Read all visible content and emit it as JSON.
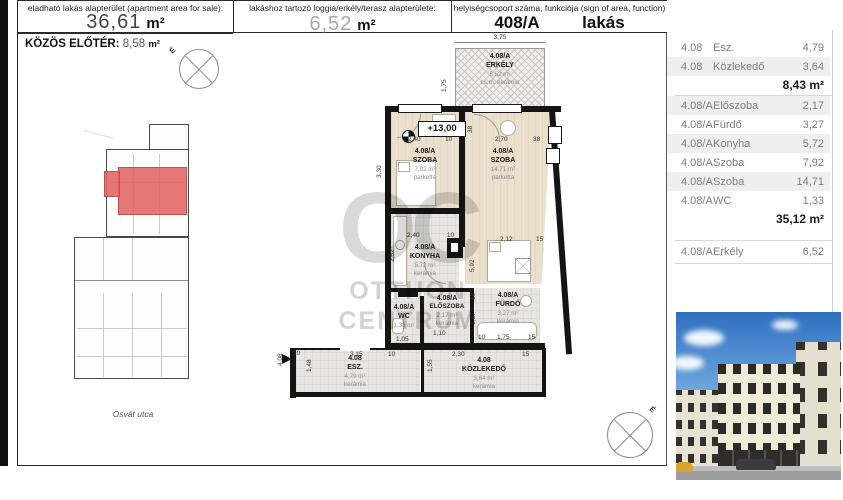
{
  "colors": {
    "highlight_red": "#E36464",
    "wall_black": "#141414",
    "wood_floor": "#EBDFCD",
    "tile_floor": "#E6E5E2",
    "table_row_shade": "#EFEFEF"
  },
  "header": {
    "col1_label": "eladható lakás alapterület (apartment area for sale):",
    "col1_value": "36,61",
    "col1_unit": "m²",
    "col1_note": "(főfalak által határolt bruttó terület, 1,90 m feletti belmagassággal) (gross area bounde by structural walls)",
    "col2_label": "lakáshoz tartozó loggia/erkély/terasz alapterülete:",
    "col2_value": "6,52",
    "col2_unit": "m²",
    "col3_label": "helyiségcsoport száma, funkciója (sign of area, function)",
    "col3_value": "408/A",
    "col3_value2": "lakás"
  },
  "left_panel": {
    "title": "KÖZÖS ELŐTÉR:",
    "value": "8,58",
    "unit": "m²",
    "street_label": "Osvát utca",
    "compass_label": "É"
  },
  "plan": {
    "level_marker": "+13,00",
    "compass_label": "É",
    "watermark_monogram": "OC",
    "watermark_line1": "OTTHON",
    "watermark_line2": "CENTRUM",
    "rooms": [
      {
        "code": "4.08/A",
        "name": "ERKÉLY",
        "area": "6,52 m²",
        "floor": "cs.m. kerámia"
      },
      {
        "code": "4.08/A",
        "name": "SZOBA",
        "area": "7,92 m²",
        "floor": "parketta"
      },
      {
        "code": "4.08/A",
        "name": "SZOBA",
        "area": "14,71 m²",
        "floor": "parketta"
      },
      {
        "code": "4.08/A",
        "name": "KONYHA",
        "area": "5,72 m²",
        "floor": "kerámia"
      },
      {
        "code": "4.08/A",
        "name": "ELŐSZOBA",
        "area": "2,17 m²",
        "floor": "kerámia"
      },
      {
        "code": "4.08/A",
        "name": "WC",
        "area": "1,33 m²",
        "floor": ""
      },
      {
        "code": "4.08/A",
        "name": "FÜRDŐ",
        "area": "3,27 m²",
        "floor": "kerámia"
      },
      {
        "code": "4.08",
        "name": "ESZ.",
        "area": "4,79 m²",
        "floor": "kerámia"
      },
      {
        "code": "4.08",
        "name": "KÖZLEKEDŐ",
        "area": "3,64 m²",
        "floor": "kerámia"
      }
    ],
    "dims": {
      "balcony_w": "3,75",
      "balcony_d": "1,75",
      "s1_w": "2,40",
      "s1_g": "10",
      "s1_h": "3,30",
      "s1_top": "38",
      "s2_w": "2,70",
      "s2_g": "38",
      "s2_h": "5,92",
      "s2_bw": "2,12",
      "s2_bg": "15",
      "k_w": "2,40",
      "k_g": "10",
      "k_h": "2,52",
      "elo_w": "1,10",
      "wc_w": "1,05",
      "f_t": "10",
      "f_h": "1,87",
      "f_b1": "10",
      "f_b2": "1,75",
      "f_b3": "15",
      "esz_w": "3,15",
      "esz_g": "10",
      "esz_h": "1,48",
      "entry_g": "20",
      "entry_code": "4,08",
      "kz_w": "2,30",
      "kz_g": "15",
      "kz_h": "1,55"
    }
  },
  "table": {
    "rows": [
      {
        "code": "4.08",
        "name": "Esz.",
        "value": "4,79"
      },
      {
        "code": "4.08",
        "name": "Közlekedő",
        "value": "3,64"
      },
      {
        "code": "4.08/A",
        "name": "Előszoba",
        "value": "2,17"
      },
      {
        "code": "4.08/A",
        "name": "Fürdő",
        "value": "3,27"
      },
      {
        "code": "4.08/A",
        "name": "Konyha",
        "value": "5,72"
      },
      {
        "code": "4.08/A",
        "name": "Szoba",
        "value": "7,92"
      },
      {
        "code": "4.08/A",
        "name": "Szoba",
        "value": "14,71"
      },
      {
        "code": "4.08/A",
        "name": "WC",
        "value": "1,33"
      }
    ],
    "subtotal_top": "8,43 m²",
    "subtotal_main": "35,12 m²",
    "balcony_row": {
      "code": "4.08/A",
      "name": "Erkély",
      "value": "6,52"
    }
  }
}
